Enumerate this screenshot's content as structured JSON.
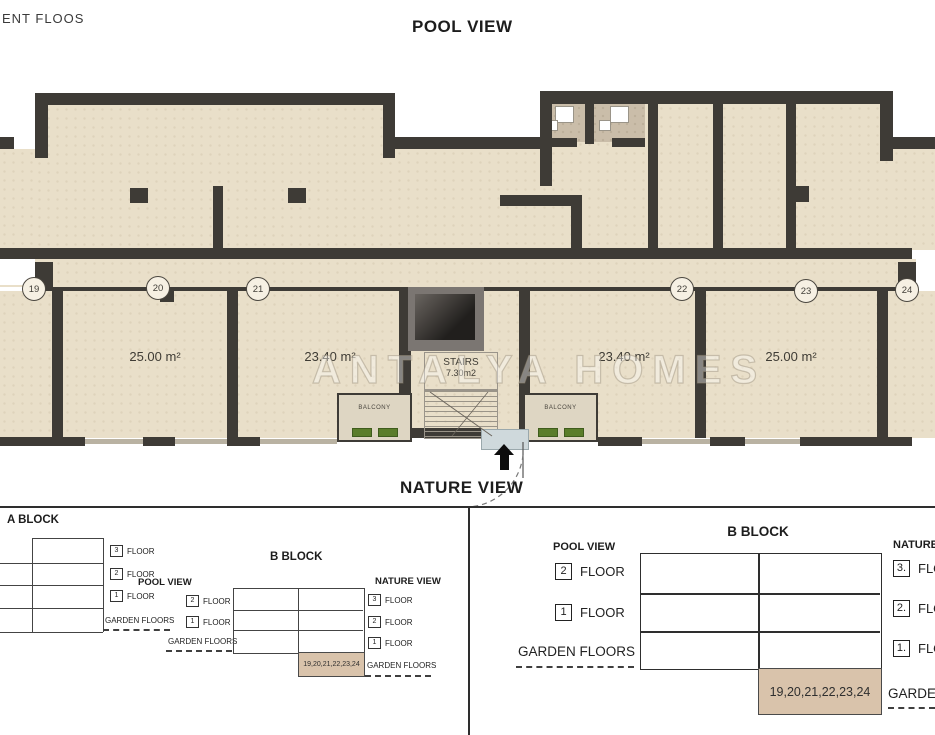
{
  "page": {
    "top_left_label": "ENT FLOOS",
    "pool_view_title": "POOL VIEW",
    "nature_view_title": "NATURE VIEW",
    "watermark": "ANTALYA HOMES"
  },
  "plan": {
    "unit_numbers": [
      "19",
      "20",
      "21",
      "22",
      "23",
      "24"
    ],
    "room_areas": [
      "25.00 m²",
      "23.40 m²",
      "23.40 m²",
      "25.00 m²"
    ],
    "stairs": {
      "label": "STAIRS",
      "area": "7.30m2"
    },
    "balcony_label": "BALCONY"
  },
  "colors": {
    "floor": "#e9dfc9",
    "wall": "#3e3b36",
    "bathroom_floor": "#cabda9",
    "highlight_cell": "#d9c3ab",
    "plant_green": "#5a7d2a",
    "entry_mat": "#cfd9dc"
  },
  "left_panel": {
    "a_block": {
      "title": "A BLOCK",
      "floors": [
        {
          "num": "3",
          "label": "FLOOR"
        },
        {
          "num": "2",
          "label": "FLOOR"
        },
        {
          "num": "1",
          "label": "FLOOR"
        }
      ],
      "garden_label": "GARDEN FLOORS"
    },
    "b_block": {
      "title": "B BLOCK",
      "pool_side_title": "POOL VIEW",
      "nature_side_title": "NATURE VIEW",
      "pool_floors": [
        {
          "num": "2",
          "label": "FLOOR"
        },
        {
          "num": "1",
          "label": "FLOOR"
        }
      ],
      "nature_floors": [
        {
          "num": "3",
          "label": "FLOOR"
        },
        {
          "num": "2",
          "label": "FLOOR"
        },
        {
          "num": "1",
          "label": "FLOOR"
        }
      ],
      "pool_garden_label": "GARDEN FLOORS",
      "nature_garden_label": "GARDEN FLOORS",
      "garden_units": "19,20,21,22,23,24"
    }
  },
  "right_panel": {
    "b_block": {
      "title": "B BLOCK",
      "pool_side_title": "POOL VIEW",
      "nature_side_title": "NATURE VIEW",
      "pool_floors": [
        {
          "num": "2",
          "label": "FLOOR"
        },
        {
          "num": "1",
          "label": "FLOOR"
        }
      ],
      "nature_floors": [
        {
          "num": "3.",
          "label": "FLOOR"
        },
        {
          "num": "2.",
          "label": "FLOOR"
        },
        {
          "num": "1.",
          "label": "FLOOR"
        }
      ],
      "pool_garden_label": "GARDEN FLOORS",
      "nature_garden_label": "GARDEN FLOORS",
      "garden_units": "19,20,21,22,23,24"
    }
  }
}
